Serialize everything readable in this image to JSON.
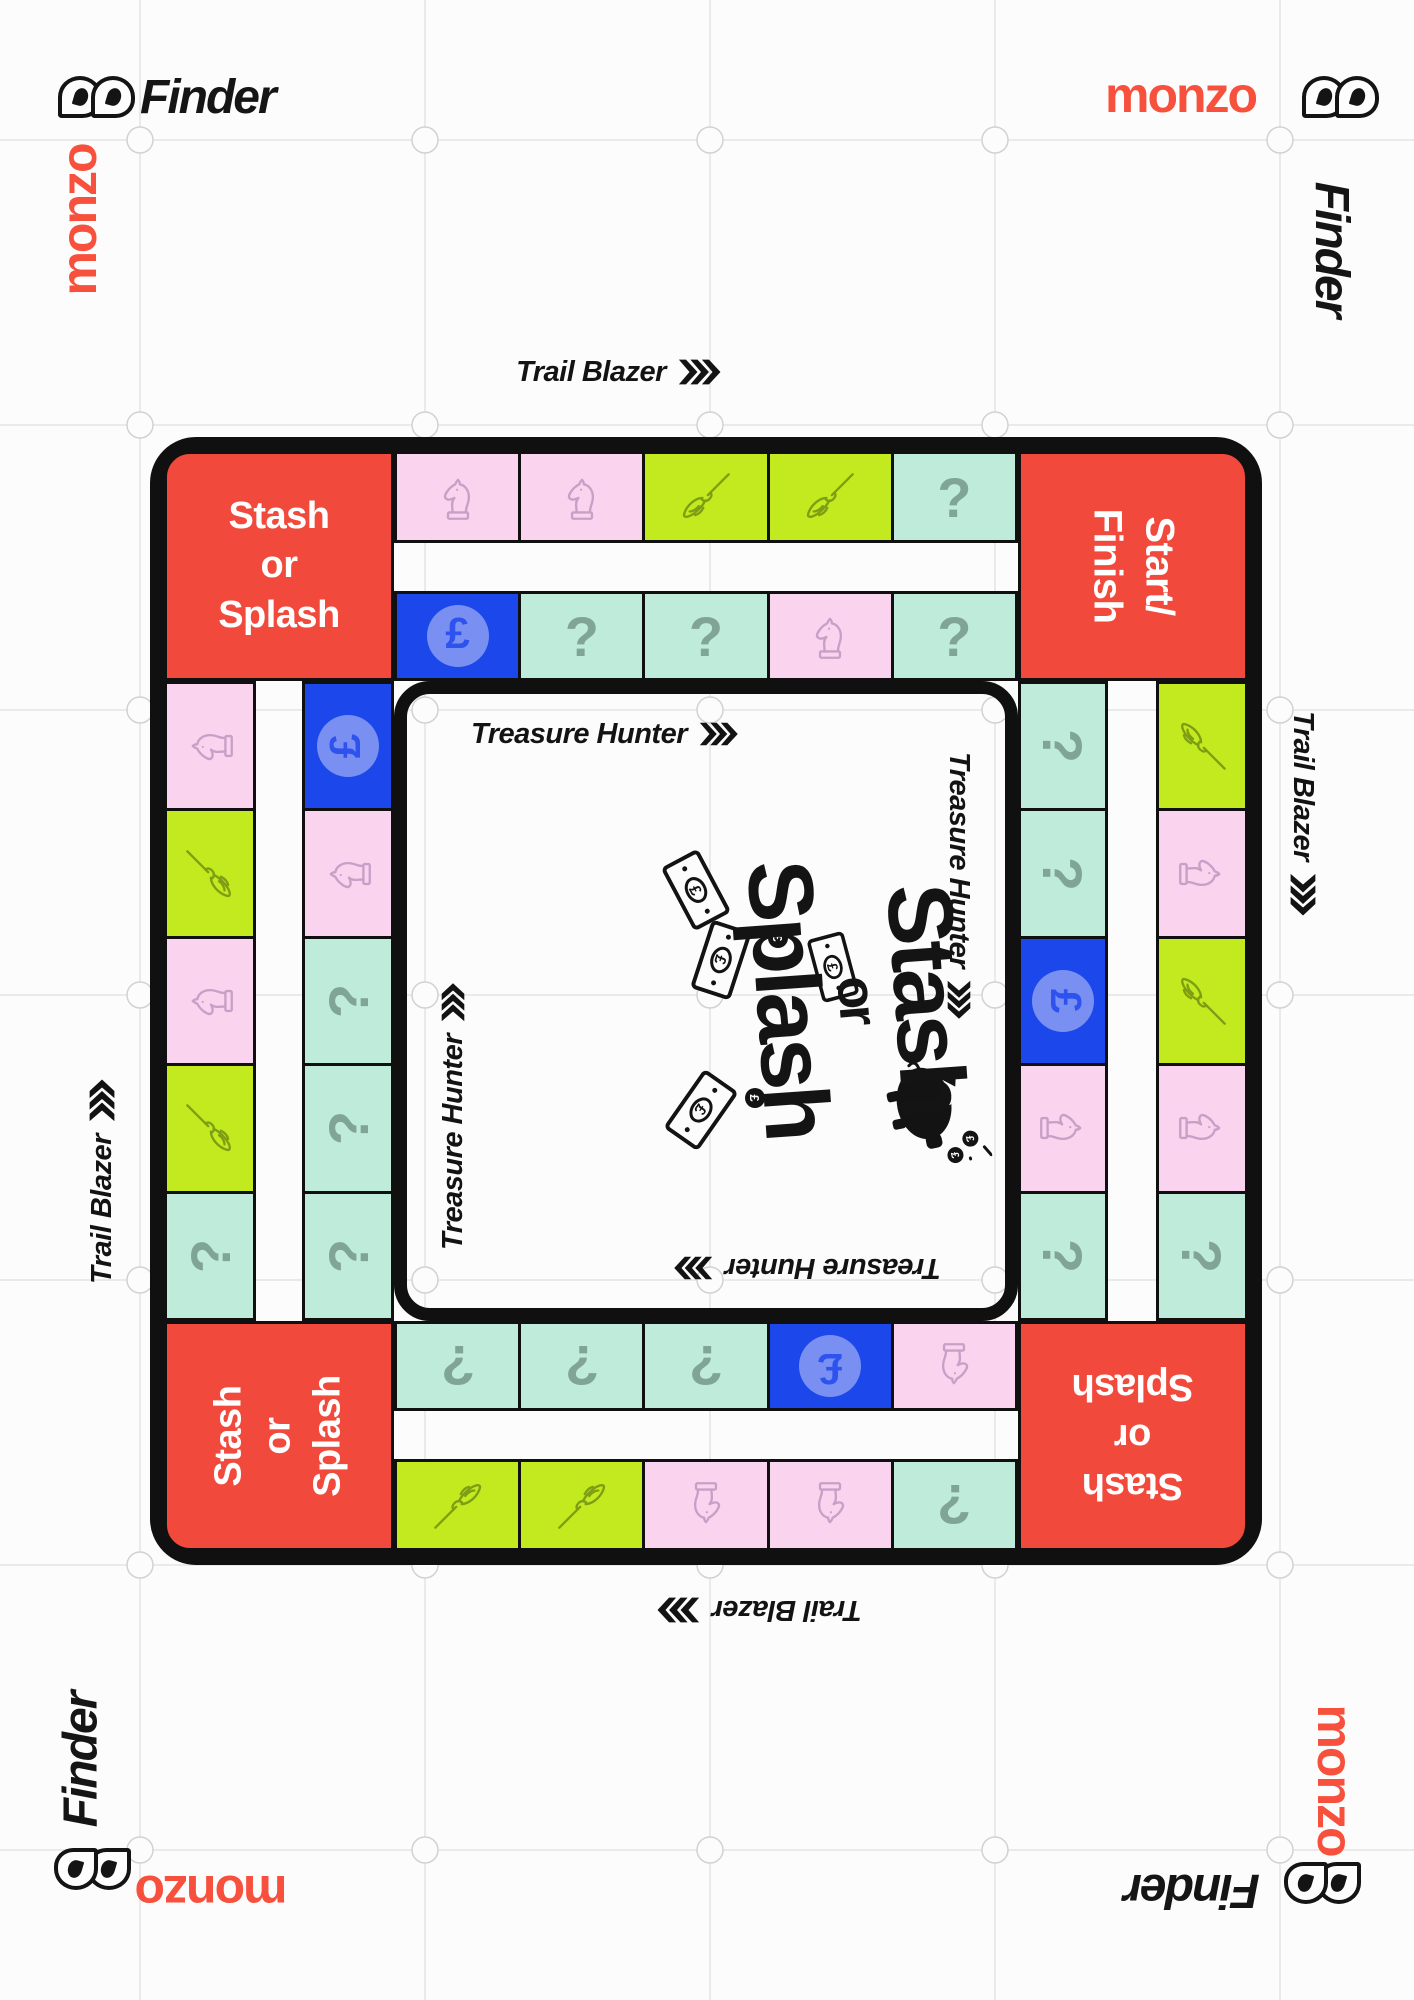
{
  "brand": {
    "finder_label": "Finder",
    "monzo_label": "monzo",
    "monzo_color": "#F7503C",
    "finder_color": "#151515"
  },
  "track_labels": {
    "outer": "Trail Blazer",
    "inner": "Treasure Hunter"
  },
  "corners": {
    "stash_lines": [
      "Stash",
      "or",
      "Splash"
    ],
    "start_lines": [
      "Start/",
      "Finish"
    ]
  },
  "center_logo": {
    "lines": [
      "Stash",
      "or",
      "Splash"
    ]
  },
  "board": {
    "colors": {
      "red": "#F14A3C",
      "pink": "#FAD4EE",
      "pink-ink": "#C99FC7",
      "lime": "#C3EA1F",
      "lime-ink": "#7E9D13",
      "mint": "#BFEBDB",
      "mint-ink": "#80A597",
      "blue": "#1C47EA",
      "blue-ell": "#7990F2",
      "blue-ink": "#2E52EE"
    },
    "icon_glyphs": {
      "question": "?",
      "pound": "£"
    },
    "tracks": {
      "top_outer": [
        "knight",
        "knight",
        "broom",
        "broom",
        "question"
      ],
      "top_inner": [
        "pound",
        "question",
        "question",
        "knight",
        "question"
      ],
      "right_outer": [
        "broom",
        "knight",
        "broom",
        "knight",
        "question"
      ],
      "right_inner": [
        "question",
        "question",
        "pound",
        "knight",
        "question"
      ],
      "bottom_outer": [
        "broom",
        "broom",
        "knight",
        "knight",
        "question"
      ],
      "bottom_inner": [
        "question",
        "question",
        "question",
        "pound",
        "knight"
      ],
      "left_outer": [
        "knight",
        "broom",
        "knight",
        "broom",
        "question"
      ],
      "left_inner": [
        "pound",
        "knight",
        "question",
        "question",
        "question"
      ]
    }
  }
}
